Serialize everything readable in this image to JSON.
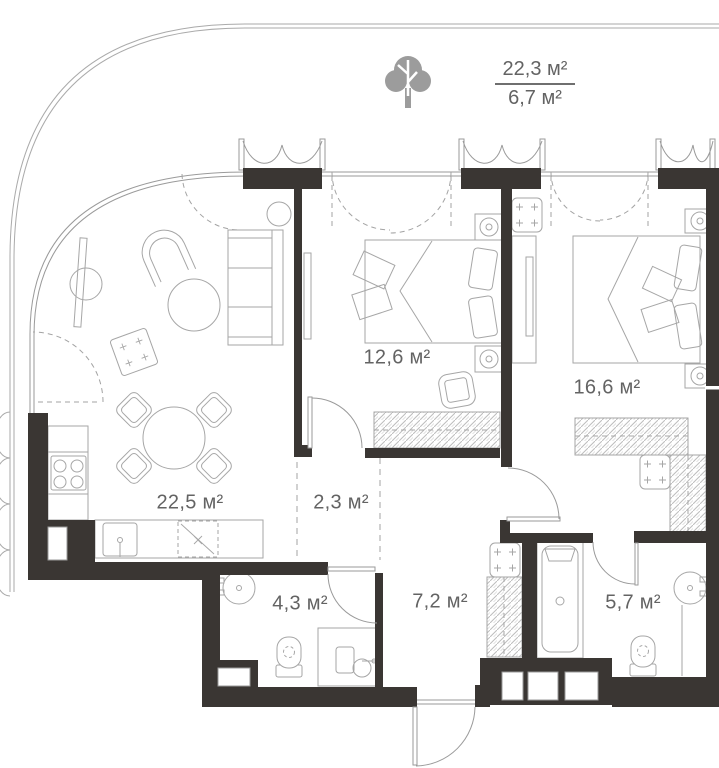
{
  "floor_plan": {
    "rooms": [
      {
        "key": "living_kitchen",
        "area": "22,5 м²"
      },
      {
        "key": "corridor",
        "area": "2,3 м²"
      },
      {
        "key": "bedroom_1",
        "area": "12,6 м²"
      },
      {
        "key": "bedroom_2",
        "area": "16,6 м²"
      },
      {
        "key": "bathroom_1",
        "area": "4,3 м²"
      },
      {
        "key": "hallway",
        "area": "7,2 м²"
      },
      {
        "key": "bathroom_2",
        "area": "5,7 м²"
      }
    ],
    "terrace": {
      "area_total": "22,3 м²",
      "area_counted": "6,7 м²"
    },
    "colors": {
      "wall": "#3a3633",
      "thin_line": "#9a9a9a",
      "furniture_line": "#a6a6a6",
      "label_text": "#636363",
      "tree_fill": "#9c9c9c",
      "hatch": "#bdbdbd"
    }
  }
}
